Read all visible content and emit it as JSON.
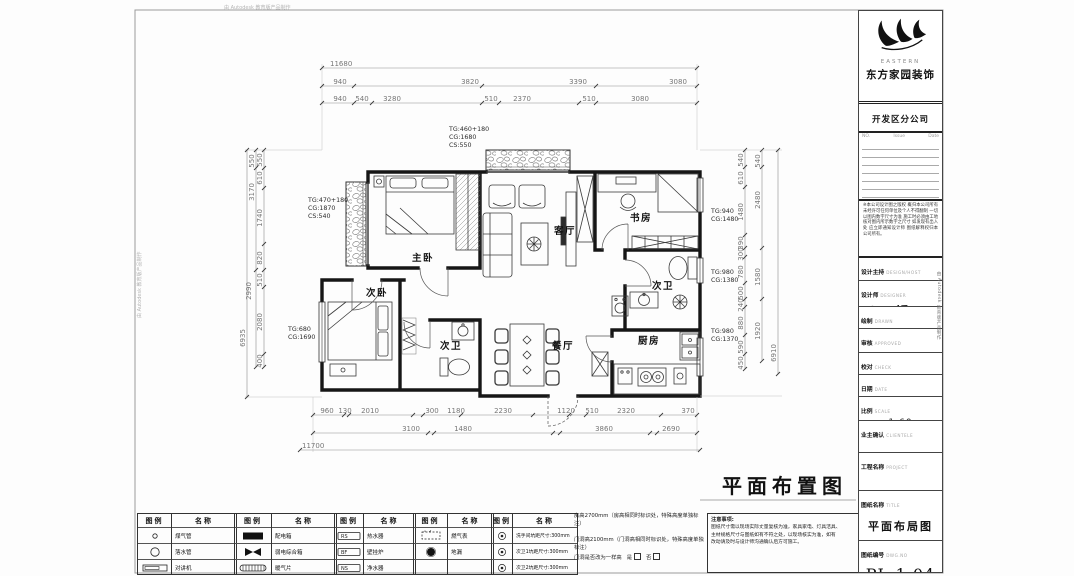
{
  "watermark": {
    "text": "由 Autodesk 教育版产品制作"
  },
  "plan": {
    "sheet_title": "平面布置图",
    "rooms": {
      "master": "主卧",
      "second": "次卧",
      "living": "客厅",
      "study": "书房",
      "bath_right": "次卫",
      "kitchen": "厨房",
      "dining": "餐厅",
      "bath_left": "次卫"
    },
    "annotations": {
      "a1": [
        "TG:460+180",
        "CG:1680",
        "CS:550"
      ],
      "a2": [
        "TG:470+180",
        "CG:1870",
        "CS:540"
      ],
      "a3": [
        "TG:680",
        "CG:1690"
      ],
      "a4": [
        "TG:940",
        "CG:1480"
      ],
      "a5": [
        "TG:980",
        "CG:1380"
      ],
      "a6": [
        "TG:980",
        "CG:1370"
      ]
    },
    "dims": {
      "top1": "11680",
      "top2": [
        "940",
        "3820",
        "3390",
        "3080"
      ],
      "top3": [
        "940",
        "540",
        "3280",
        "510",
        "2370",
        "510",
        "3080"
      ],
      "bottom1": [
        "960",
        "130",
        "2010",
        "300",
        "1180",
        "2230",
        "1120",
        "510",
        "2320",
        "370"
      ],
      "bottom2": [
        "3100",
        "1480",
        "3860",
        "2690"
      ],
      "bottom3": "11700",
      "left_inner": [
        "550",
        "610",
        "1740",
        "820",
        "510",
        "2080",
        "400"
      ],
      "left_mid": [
        "550",
        "3170",
        "2990"
      ],
      "left_outer": "6935",
      "right_inner": [
        "540",
        "610",
        "1480",
        "390",
        "300",
        "780",
        "500",
        "240",
        "880",
        "590",
        "450"
      ],
      "right_mid": [
        "540",
        "2480",
        "1580",
        "1920"
      ],
      "right_outer": "6910"
    }
  },
  "legend": {
    "header_icon": "图例",
    "header_name": "名称",
    "g1": [
      {
        "name": "煤气管"
      },
      {
        "name": "落水管"
      },
      {
        "name": "对讲机"
      }
    ],
    "g2": [
      {
        "name": "配电箱"
      },
      {
        "name": "弱电综合箱"
      },
      {
        "name": "暖气片"
      }
    ],
    "g3": [
      {
        "tag": "RS",
        "name": "热水器"
      },
      {
        "tag": "BF",
        "name": "壁挂炉"
      },
      {
        "tag": "NS",
        "name": "净水器"
      }
    ],
    "g4": [
      {
        "name": "燃气表"
      },
      {
        "name": "地漏"
      },
      {
        "name": ""
      }
    ],
    "g5": [
      {
        "name": "洗手间坑距尺寸:300mm"
      },
      {
        "name": "次卫1坑距尺寸:300mm"
      },
      {
        "name": "次卫2坑距尺寸:300mm"
      }
    ],
    "notes": {
      "room_height": "房高2700mm（房高相同时标识处，特殊高度单独标注）",
      "door_height": "门洞高2100mm（门洞高相同时标识处，特殊高度单独标注）",
      "door_question": "门洞是否改为一样高",
      "yes": "是",
      "no": "否",
      "notice_title": "注意事项:",
      "notice_lines": [
        "图纸尺寸需以现场实际丈量复核为准，家具家电、灯具洁具、",
        "主材规格尺寸与图纸如有不符之处，以现场核实为准，如有",
        "改动请及时与设计师沟通确认后方可施工。"
      ]
    }
  },
  "titleblock": {
    "logo_en": "EASTERN",
    "company": "东方家园装饰",
    "branch": "开发区分公司",
    "rev": {
      "no": "NO.",
      "issue": "Issue",
      "date": "Date"
    },
    "disclaimer": "※本公司设计图之版权 概归本公司所有 未经许可任何单位及个人不得翻制 一切以图内数字尺寸为准 施工时必须由工地核对图内所示数字之尺寸 如发现有出入处 应立即通知设计师 图纸解释权归本公司所有。",
    "rows": [
      {
        "zh": "设计主持",
        "en": "DESIGN/HOST",
        "value": ""
      },
      {
        "zh": "设计师",
        "en": "DESIGNER",
        "value": "杨丽娟"
      },
      {
        "zh": "绘制",
        "en": "DRAWN",
        "value": ""
      },
      {
        "zh": "审核",
        "en": "APPROVED",
        "value": ""
      },
      {
        "zh": "校对",
        "en": "CHECK",
        "value": ""
      },
      {
        "zh": "日期",
        "en": "DATE",
        "value": ""
      },
      {
        "zh": "比例",
        "en": "SCALE",
        "value": "1:60"
      },
      {
        "zh": "业主确认",
        "en": "CLIENTELE",
        "value": ""
      },
      {
        "zh": "工程名称",
        "en": "PROJECT",
        "value": ""
      },
      {
        "zh": "图纸名称",
        "en": "TITLE",
        "value": "平面布局图"
      },
      {
        "zh": "图纸编号",
        "en": "DWG.NO",
        "value": "PL-1.04"
      }
    ]
  }
}
